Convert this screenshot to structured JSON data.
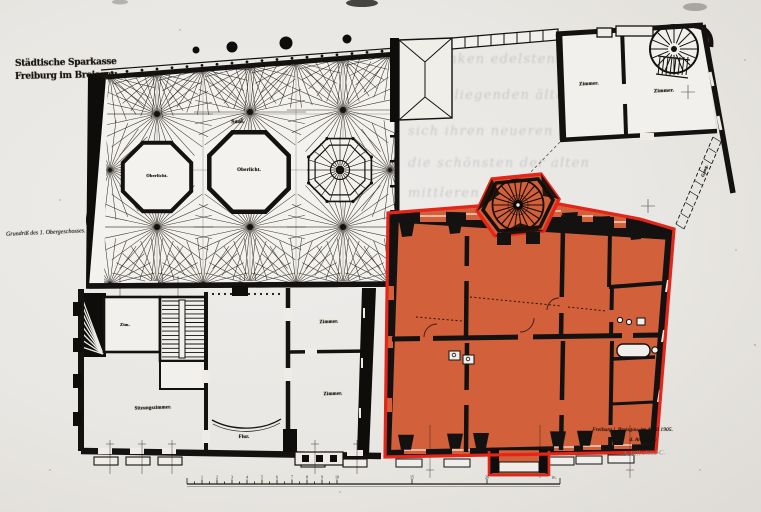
{
  "doc": {
    "title_line1": "Städtische Sparkasse",
    "title_line2": "Freiburg im Breisgau.",
    "side_note": "Grundriß des 1. Obergeschosses.",
    "date_note": "Freiburg i. Breisgau, im April 1905.",
    "architect_note": "d. Architekt:",
    "signature": "A. Hillschied-C.",
    "colors": {
      "highlight_fill": "#d2603a",
      "highlight_outline": "#e52517",
      "paper": "#e9e7e3",
      "ink": "#141210"
    }
  },
  "plan": {
    "hall_label": "Saal.",
    "octagon1_label": "Oberlicht.",
    "octagon2_label": "Oberlicht.",
    "left_wing": {
      "room_small": "Zim.",
      "room_large": "Sitzungszimmer.",
      "hall": "Flur.",
      "room_a": "Zimmer.",
      "room_b": "Zimmer."
    },
    "right_wing": {
      "room_a": "Zimmer.",
      "room_b": "Zimmer.",
      "corridor": "Gang."
    }
  },
  "ghost_text": {
    "lines": [
      "schlanken edelsten",
      "nebenliegenden älteren",
      "sich ihren neueren bei",
      "die schönsten der alten",
      "mittleren und"
    ]
  },
  "scale_bar": {
    "labels": [
      "1",
      "2",
      "3",
      "4",
      "5",
      "6",
      "7",
      "8",
      "9",
      "10",
      "15",
      "20"
    ],
    "unit": "m."
  }
}
